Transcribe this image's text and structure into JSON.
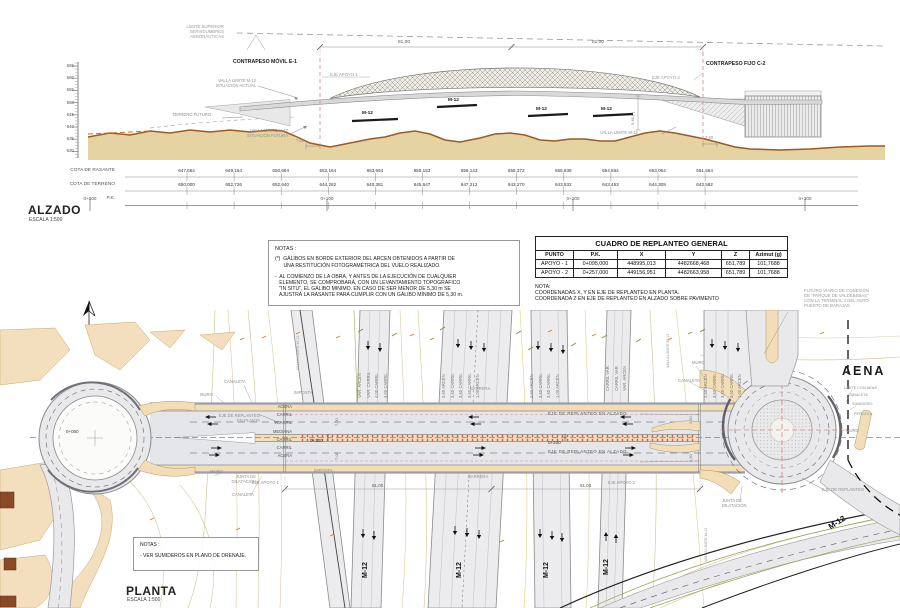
{
  "alzado": {
    "title": "ALZADO",
    "scale": "ESCALA 1:500",
    "ruler": [
      "665",
      "660",
      "655",
      "650",
      "645",
      "640",
      "635",
      "630"
    ],
    "limite_superior": "LIMITE SUPERIOR\nSERVIDUMBRES\nAERONÁUTICAS",
    "contrapeso_movil": "CONTRAPESO MÓVIL E-1",
    "contrapeso_fijo": "CONTRAPESO FIJO C-2",
    "eje_apoyo_1": "EJE APOYO 1",
    "eje_apoyo_2": "EJE APOYO 2",
    "valla_actual": "VALLA LIMITE M-12\nSITUACIÓN ACTUAL",
    "valla_futura": "VALLA LIMITE M-12\nSITUACIÓN FUTURA",
    "valla_limite": "VALLA LIMITE M-12",
    "terreno_futuro": "TERRENO FUTURO",
    "span_left": "81,00",
    "span_right": "81,00",
    "dim_izq": "7,50",
    "dim_der": "7,50",
    "galibo": "5,45 (*)",
    "m12": "M-12"
  },
  "perfil": {
    "row1_label": "COTA DE RASANTE",
    "row2_label": "COTA DE TERRENO",
    "pk_label": "P.K.",
    "rasante": [
      "647,664",
      "649,164",
      "650,664",
      "652,164",
      "653,664",
      "655,153",
      "656,143",
      "656,372",
      "655,839",
      "654,564",
      "653,064",
      "651,564"
    ],
    "terreno": [
      "650,000",
      "652,726",
      "652,640",
      "644,262",
      "640,381",
      "645,647",
      "647,212",
      "643,270",
      "643,532",
      "643,453",
      "644,309",
      "643,582"
    ],
    "pk0": "0+000",
    "pk1": "0+100",
    "pk2": "0+200",
    "pk3": "0+300"
  },
  "notas_alzado": {
    "title": "NOTAS :",
    "item1": "(*)  GÁLIBOS EN BORDE EXTERIOR DEL ARCEN OBTENIDOS A PARTIR DE\n      UNA RESTITUCIÓN FOTOGRAMÉTRICA DEL VUELO REALIZADO.",
    "item2": "-  AL COMIENZO DE LA OBRA, Y ANTES DE LA EJECUCIÓN DE CUALQUIER\n   ELEMENTO, SE COMPROBARÁ, CON UN LEVANTAMIENTO TOPOGRAFICO\n   \"IN SITU\", EL GÁLIBO MINIMO. EN CASO DE SER MENOR DE 5,30 m SE\n   AJUSTRÁ LA RASANTE PARA CUMPLIR CON UN GÁLIBO MÍNIMO DE 5,30 m."
  },
  "cuadro": {
    "title": "CUADRO DE REPLANTEO GENERAL",
    "headers": [
      "PUNTO",
      "P.K.",
      "X",
      "Y",
      "Z",
      "Azimut (g)"
    ],
    "rows": [
      [
        "APOYO - 1",
        "0+095,000",
        "448995,013",
        "4482668,468",
        "651,789",
        "101,7688"
      ],
      [
        "APOYO - 2",
        "0+257,000",
        "449156,951",
        "4482663,958",
        "651,789",
        "101,7688"
      ]
    ],
    "nota_title": "NOTA:",
    "nota1": "COORDENADAS X, Y EN EJE DE REPLANTEO EN PLANTA.",
    "nota2": "COORDENADA Z EN EJE DE REPLANTEO EN ALZADO SOBRE PAVIMENTO"
  },
  "futuro_viario": "FUTURO VIARIO DE CONEXIÓN\nDE \"PARQUE DE VALDEBEBAS\"\nCON LA TERMINAL 4 DEL AERO-\nPUERTO DE BARAJAS",
  "planta": {
    "title": "PLANTA",
    "scale": "ESCALA 1:500",
    "aena": "AENA",
    "notas_title": "NOTAS :",
    "notas_item": "- VER SUMIDEROS EN PLANO DE DRENAJE.",
    "pk0": "0+000",
    "pk1": "0+100",
    "pk2": "0+200",
    "eje_planta": "EJE DE REPLANTEO\nEN PLANTA",
    "eje_alzado": "EJE  DE  REPLANTEO  EN  ALZADO",
    "eje_replanteo": "EJE DE REPLANTEO",
    "eje_apoyo_1": "EJE APOYO 1",
    "eje_apoyo_2": "EJE APOYO 2",
    "muro": "MURO",
    "canaleta": "CANALETA",
    "imposta": "IMPOSTA",
    "barrera": "BARRERA",
    "junta": "JUNTA DE\nDILATACIÓN",
    "limite_aena": "LIMITE CON AENA",
    "sumidero": "SUMIDERO",
    "pergola": "PERGOLA",
    "valla": "VALLA LIMITE M-12",
    "m12": "M-12",
    "dim_81_l": "81,00",
    "dim_81_r": "81,00",
    "dim_700": "7,00",
    "dim_250": "2,50",
    "carriles_stack": [
      "ACERA",
      "CARRIL",
      "CARRIL",
      "MEDIANA",
      "CARRIL",
      "CARRIL",
      "ACERA"
    ],
    "lanes_a": [
      "VAR. ARCÉN",
      "VAR. CARRIL",
      "4,00 CARRIL",
      "4,00 CARRIL"
    ],
    "lanes_b": [
      "2,50 ARCÉN",
      "3,50 CARRIL",
      "3,50 CARRIL",
      "3,50 CARRIL",
      "1,00 ARCÉN"
    ],
    "lanes_c": [
      "2,50 ARCÉN",
      "3,50 CARRIL",
      "3,50 CARRIL",
      "1,00 ARCÉN"
    ],
    "lanes_d": [
      "CARRIL VAR.",
      "CARRIL VAR.",
      "VAR. ARCÉN"
    ],
    "lanes_e": [
      "2,50 ARCÉN",
      "3,50 CARRIL",
      "3,50 CARRIL",
      "3,50 CARRIL",
      "1,00 ARCÉN"
    ]
  }
}
